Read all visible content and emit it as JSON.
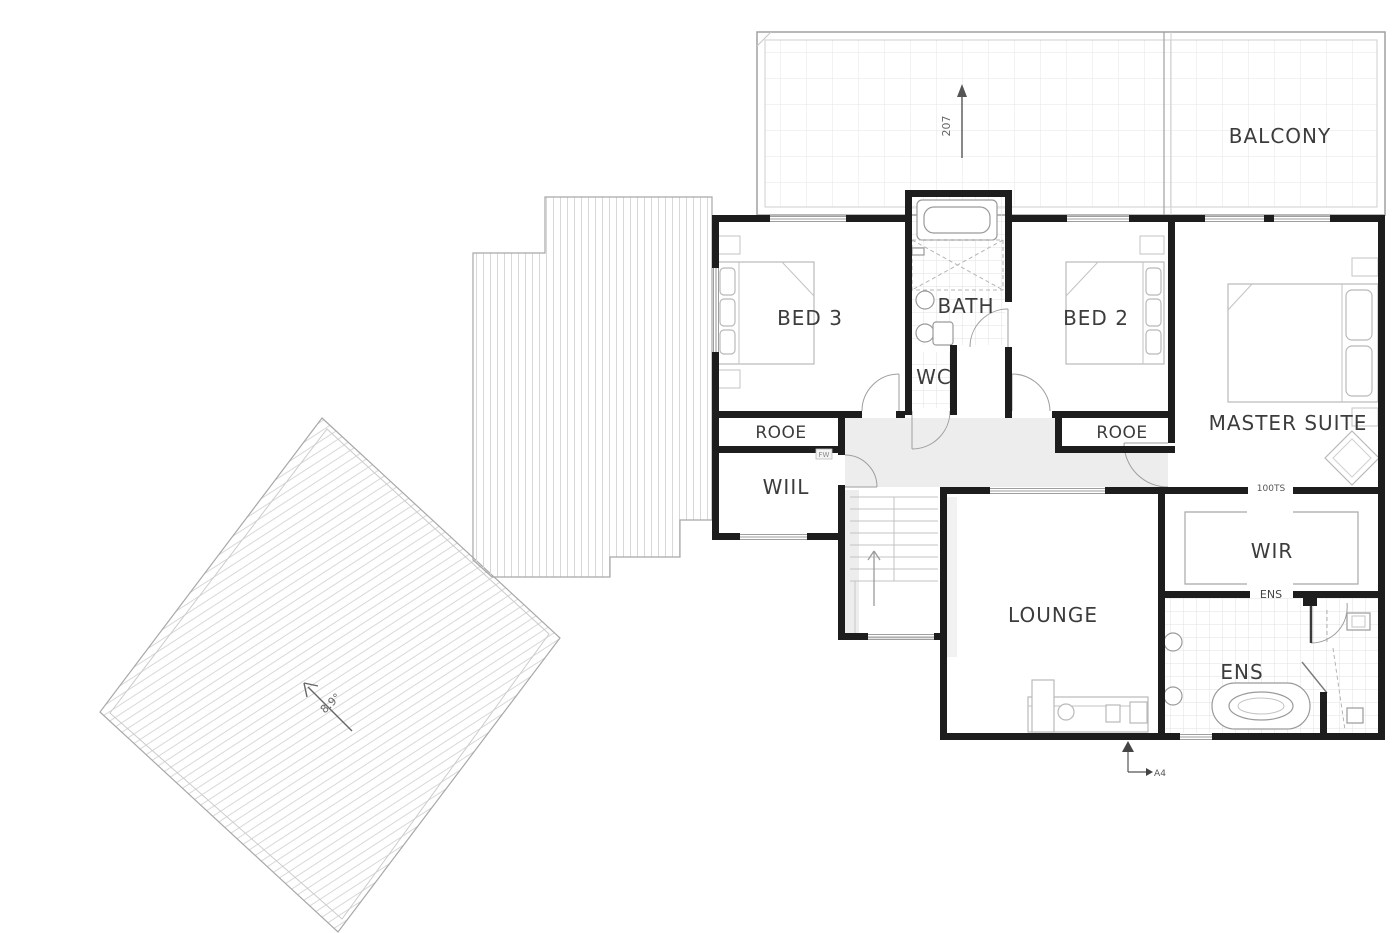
{
  "rooms": {
    "balcony": {
      "label": "BALCONY"
    },
    "bed3": {
      "label": "BED 3"
    },
    "bath": {
      "label": "BATH"
    },
    "wc": {
      "label": "WC"
    },
    "bed2": {
      "label": "BED 2"
    },
    "master_suite": {
      "label": "MASTER SUITE"
    },
    "robe_bed3": {
      "label": "ROOE"
    },
    "robe_bed2": {
      "label": "ROOE"
    },
    "linen": {
      "label": "WIIL"
    },
    "lounge": {
      "label": "LOUNGE"
    },
    "wir": {
      "label": "WIR"
    },
    "ens": {
      "label": "ENS"
    }
  },
  "annotations": {
    "terrace_fall_arrow": "207",
    "roof_pitch_arrow": "8.9°",
    "wir_opening_tag": "100TS",
    "ens_opening_tag": "ENS",
    "linen_door_tag": "FW",
    "section_tag": "A4"
  },
  "colors": {
    "wall": "#1d1d1d",
    "outline": "#9e9e9e",
    "furniture": "#b9b9b9",
    "tile_line": "#e2e2e2",
    "roof_line": "#d8d8d8",
    "shadow": "#ededed",
    "label_text": "#3c3c3c"
  }
}
